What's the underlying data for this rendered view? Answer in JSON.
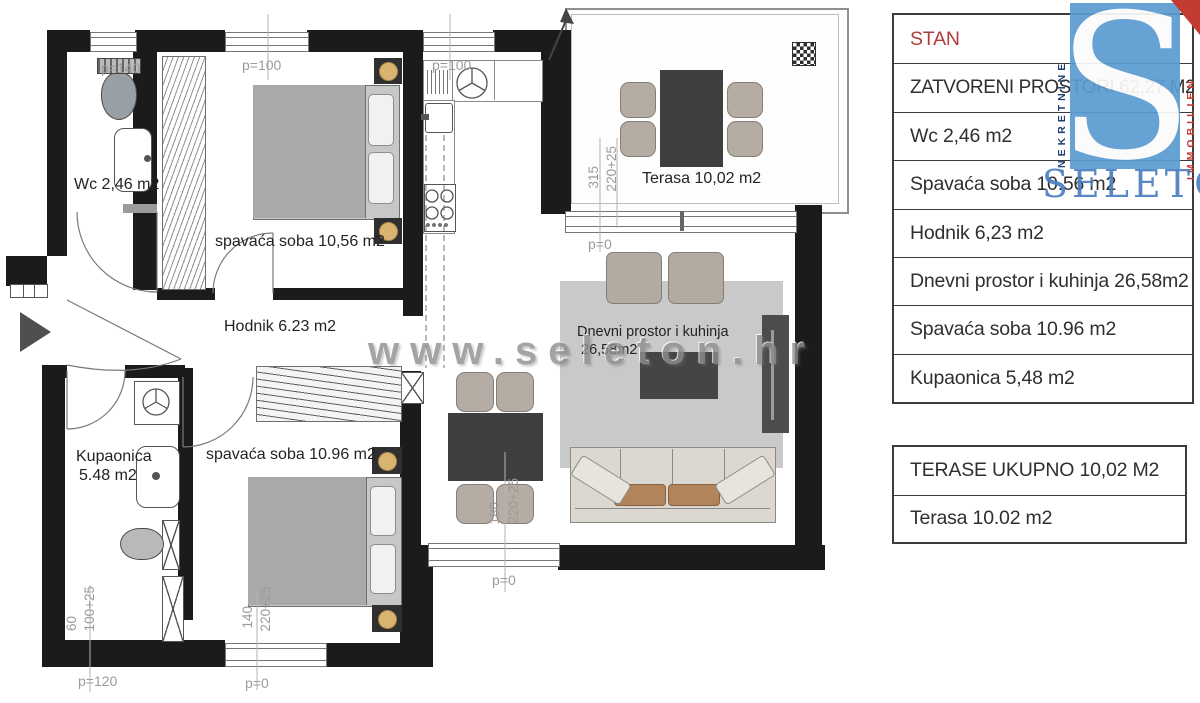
{
  "watermark": "www.seleton.hr",
  "panel": {
    "main_table": {
      "rows": [
        "STAN",
        "ZATVORENI PROSTORI 62,27 M2",
        "Wc 2,46 m2",
        "Spavaća soba 10.56 m2",
        "Hodnik 6,23 m2",
        "Dnevni prostor i kuhinja  26,58m2",
        "Spavaća soba 10.96  m2",
        "Kupaonica 5,48 m2"
      ]
    },
    "terrace_table": {
      "rows": [
        "TERASE UKUPNO  10,02 M2",
        "Terasa 10.02 m2"
      ]
    }
  },
  "logo": {
    "letter": "S",
    "brand": "SELETON",
    "left_vertical": "NEKRETNINE",
    "right_vertical": "IMMOBILIEN"
  },
  "colors": {
    "logo_blue": "#5b9bd1",
    "logo_red": "#c33b32",
    "brand_text_blue": "#4a80c1",
    "brand_navy": "#1d3f6f",
    "stan_red": "#b23c3c",
    "wall_black": "#1b1b1b",
    "watermark_gray": "#8e8e8e"
  },
  "plan": {
    "rooms": {
      "wc": "Wc 2,46 m2",
      "bedroom1": "spavaća soba 10,56 m2",
      "hallway": "Hodnik 6.23 m2",
      "bathroom_line1": "Kupaonica",
      "bathroom_line2": "5.48 m2",
      "bedroom2": "spavaća soba 10.96 m2",
      "living_line1": "Dnevni prostor i kuhinja",
      "living_line2": "26,58m2",
      "terrace": "Terasa 10,02 m2"
    },
    "dims": {
      "p100_bedroom1": "p=100",
      "p100_kitchen": "p=100",
      "p140_wc": "p=140",
      "p0_terrace": "p=0",
      "p0_living": "p=0",
      "p0_bedroom2": "p=0",
      "p120_bath": "p=120",
      "d315": "315",
      "d220_terrace": "220+25",
      "d180": "180",
      "d220_dining": "220+25",
      "d140": "140",
      "d220_bedroom2": "220+25",
      "d60": "60",
      "d100_25": "100+25"
    }
  }
}
